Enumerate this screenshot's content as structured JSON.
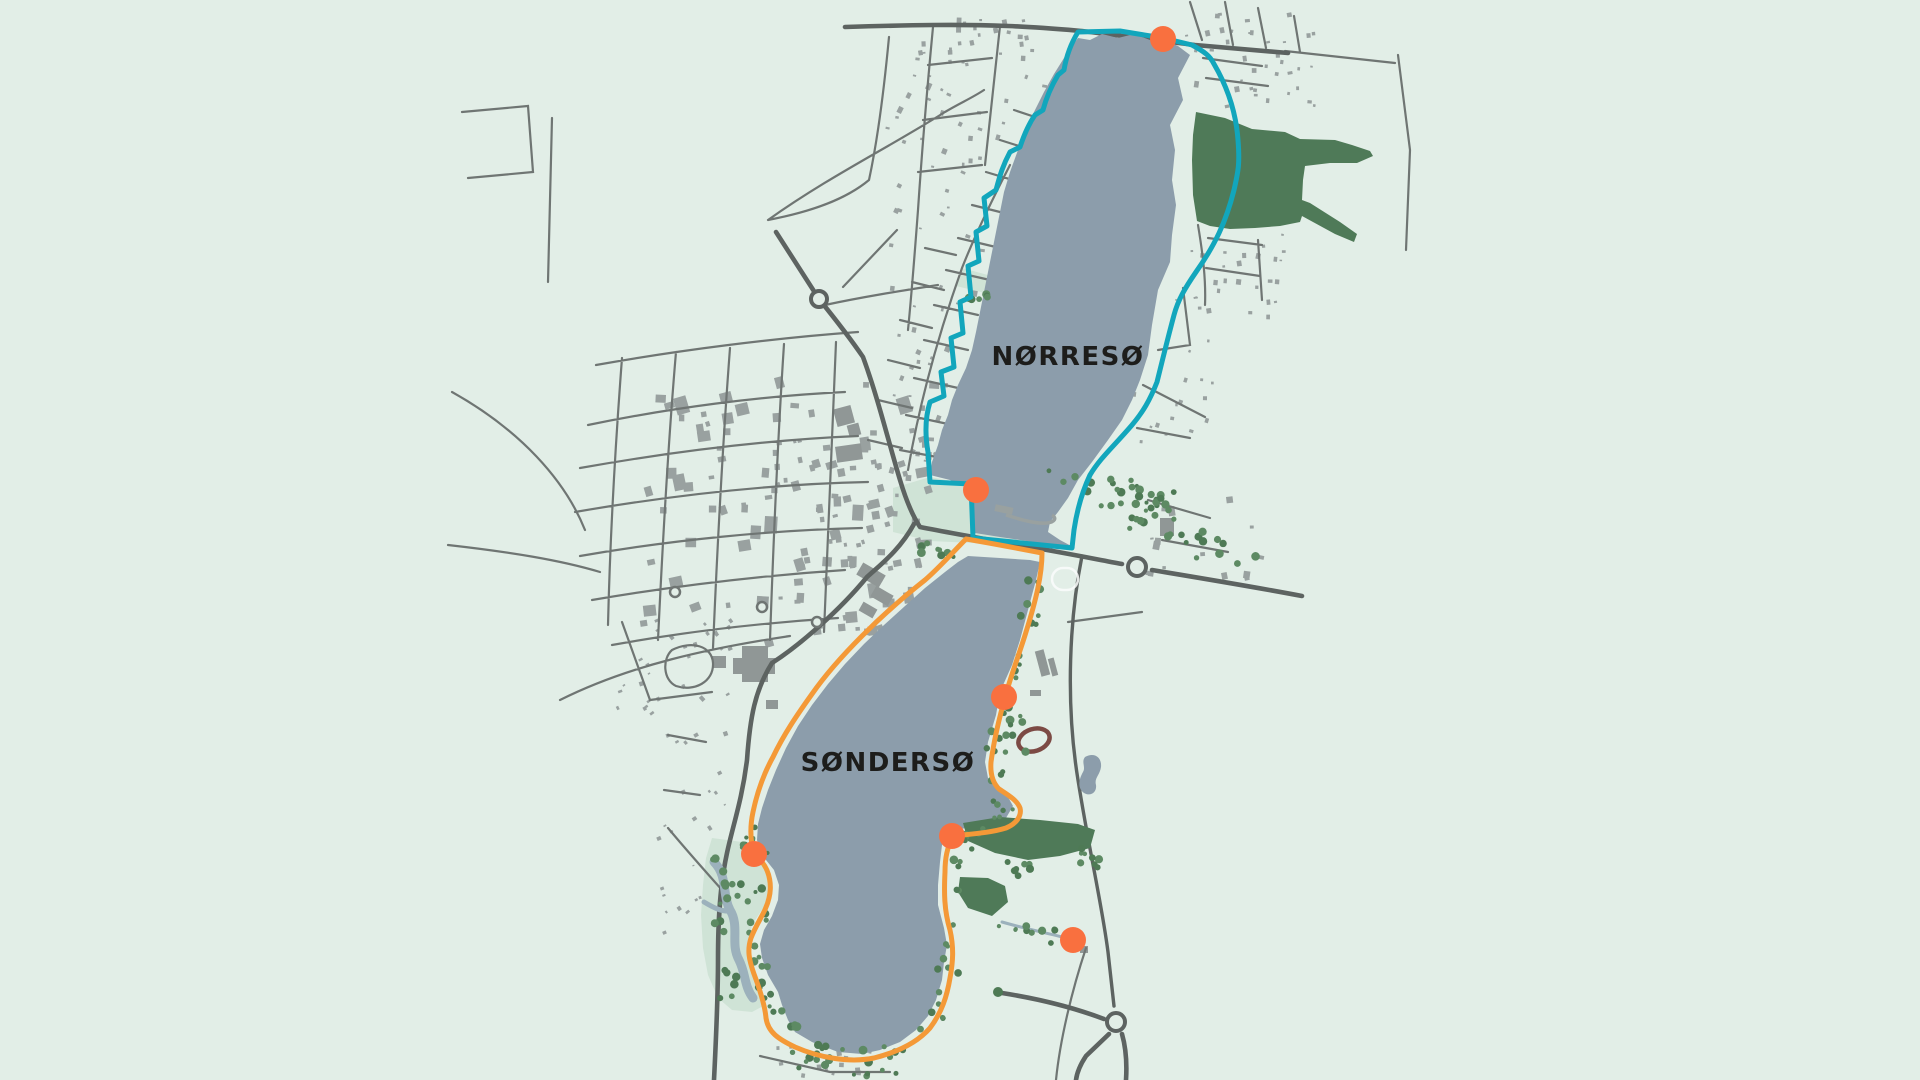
{
  "map": {
    "background_color": "#e2eee7",
    "lake_color": "#8c9dab",
    "park_color": "#cfe3d6",
    "forest_color": "#4f7a58",
    "tree_color": "#4e7a55",
    "road_main_color": "#5d6361",
    "road_minor_color": "#6f7573",
    "building_color": "#99a1a0",
    "stream_color": "#9cb1bc",
    "stadium_track_color": "#7c4a44",
    "lakes": [
      {
        "id": "norreso",
        "label": "NØRRESØ"
      },
      {
        "id": "sonderso",
        "label": "SØNDERSØ"
      }
    ],
    "routes": [
      {
        "id": "norreso-route",
        "color": "#12a6bc"
      },
      {
        "id": "sonderso-route",
        "color": "#f49937"
      }
    ],
    "markers": {
      "color": "#f9703f",
      "radius": 13,
      "points": [
        {
          "x": 1163,
          "y": 39
        },
        {
          "x": 976,
          "y": 490
        },
        {
          "x": 1004,
          "y": 697
        },
        {
          "x": 952,
          "y": 836
        },
        {
          "x": 754,
          "y": 854
        },
        {
          "x": 1073,
          "y": 940
        }
      ]
    }
  }
}
